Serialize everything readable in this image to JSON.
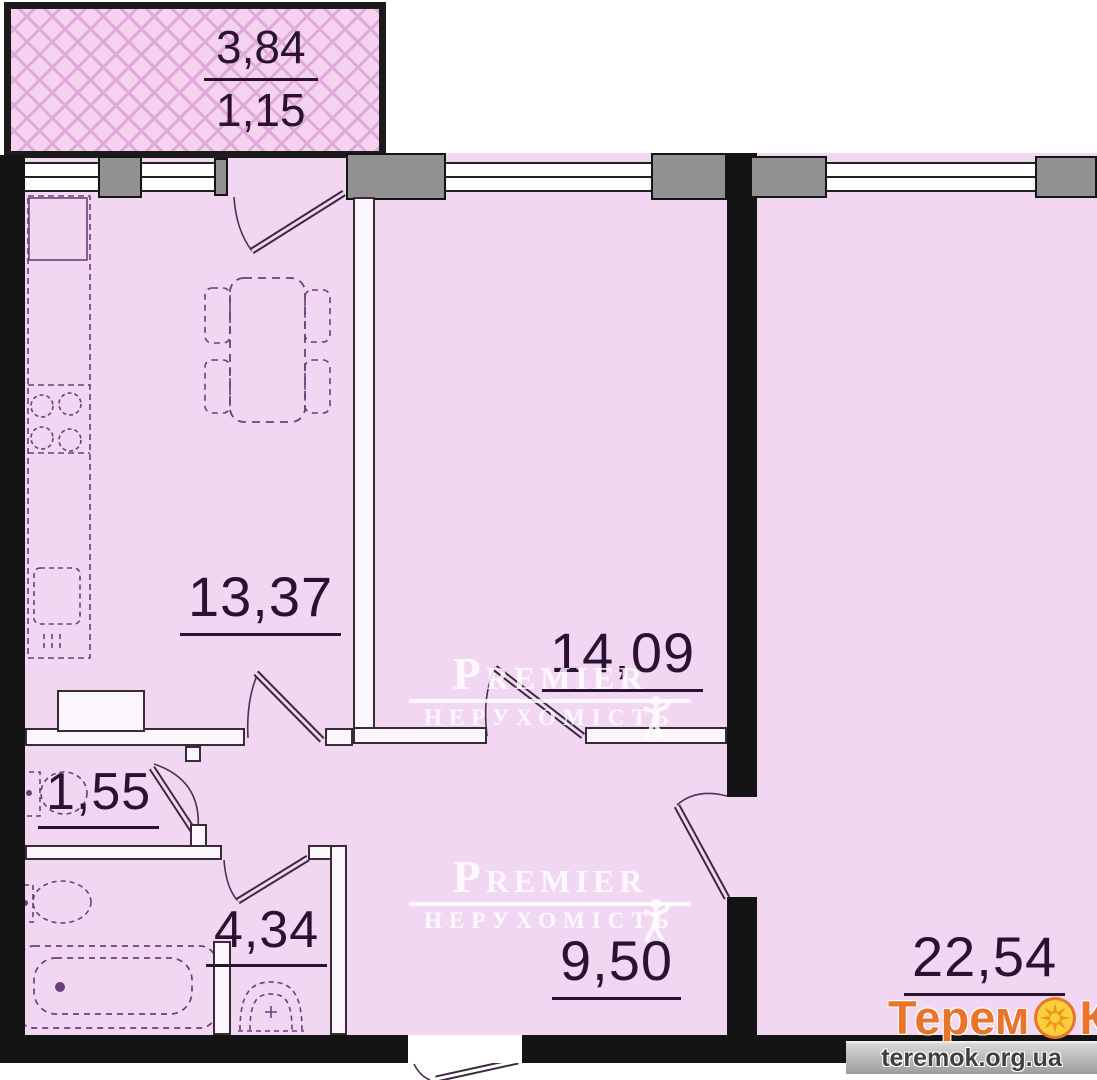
{
  "rooms": {
    "balcony": {
      "area_upper": "3,84",
      "area_lower": "1,15"
    },
    "kitchen_living": {
      "area": "13,37"
    },
    "bedroom": {
      "area": "14,09"
    },
    "wc": {
      "area": "1,55"
    },
    "bath_hall": {
      "area": "4,34"
    },
    "hallway": {
      "area": "9,50"
    },
    "living_room": {
      "area": "22,54"
    }
  },
  "watermark": {
    "brand": "Premier",
    "subtitle": "НЕРУХОМІСТЬ"
  },
  "logo": {
    "brand_start": "Терем",
    "brand_end": "К",
    "website": "teremok.org.ua"
  },
  "colors": {
    "floor": "#f2d7f3",
    "wall": "#141414",
    "hatch": "#dfa9da",
    "fixture_line": "#6b3f77",
    "label_text": "#2a1233",
    "logo_orange": "#e8752a",
    "sun_yellow": "#f7d03c",
    "watermark": "#ffffff"
  }
}
